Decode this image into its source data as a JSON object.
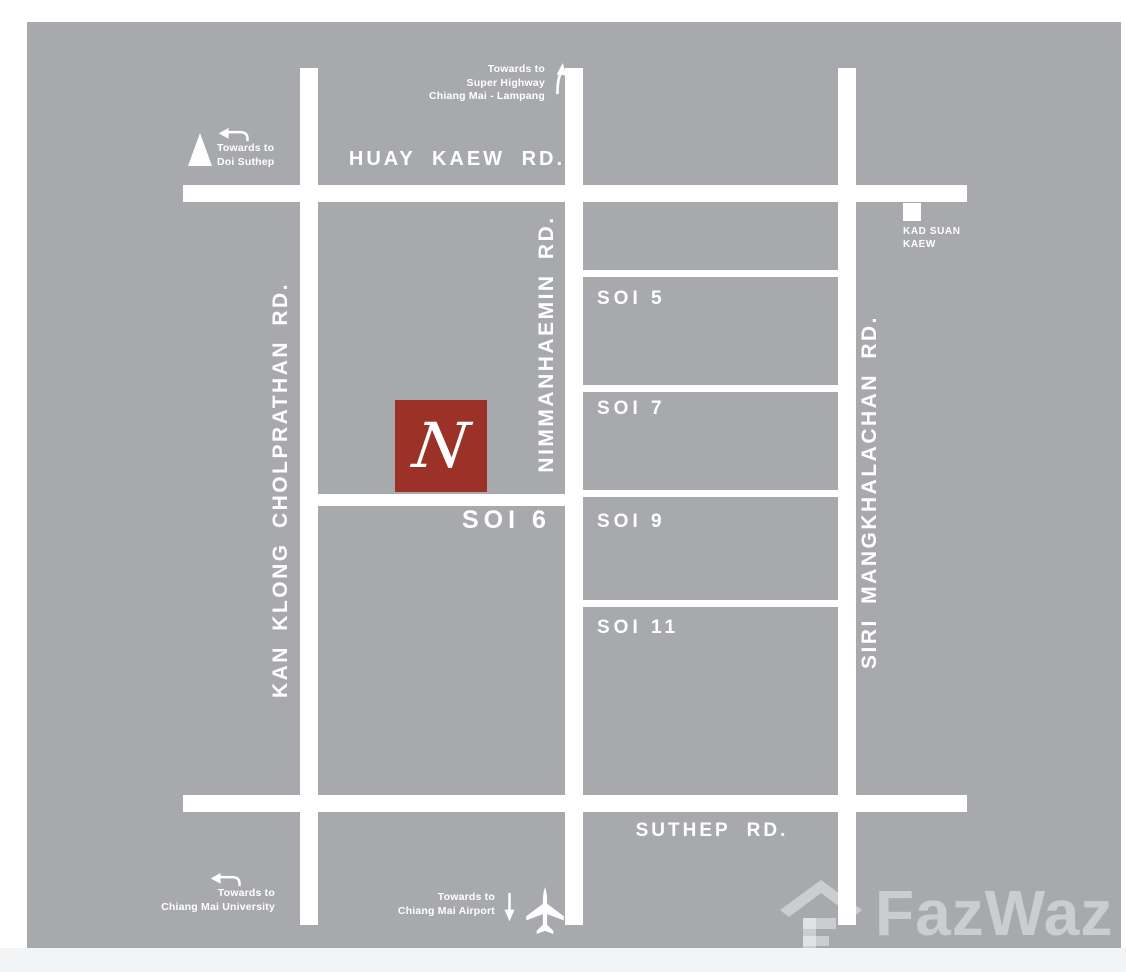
{
  "page": {
    "background": "#ffffff",
    "footer_strip_color": "#f3f4f5"
  },
  "map": {
    "background": "#a8a9ad",
    "road_color": "#ffffff",
    "roads": {
      "huay_kaew": "HUAY KAEW RD.",
      "suthep": "SUTHEP RD.",
      "nimmanhaemin": "NIMMANHAEMIN RD.",
      "kan_klong_cholprathan": "KAN KLONG CHOLPRATHAN RD.",
      "siri_mangkhalachan": "SIRI MANGKHALACHAN RD.",
      "soi5": "SOI 5",
      "soi6": "SOI 6",
      "soi7": "SOI 7",
      "soi9": "SOI 9",
      "soi11": "SOI 11"
    },
    "marker": {
      "letter": "N",
      "color": "#9c3128"
    },
    "landmarks": {
      "kad_suan_kaew": {
        "line1": "KAD SUAN",
        "line2": "KAEW"
      }
    },
    "directions": {
      "doi_suthep": {
        "line1": "Towards to",
        "line2": "Doi Suthep"
      },
      "super_highway": {
        "line1": "Towards to",
        "line2": "Super Highway",
        "line3": "Chiang Mai - Lampang"
      },
      "university": {
        "line1": "Towards to",
        "line2": "Chiang Mai University"
      },
      "airport": {
        "line1": "Towards to",
        "line2": "Chiang Mai Airport"
      }
    },
    "watermark": {
      "text": "FazWaz"
    }
  }
}
